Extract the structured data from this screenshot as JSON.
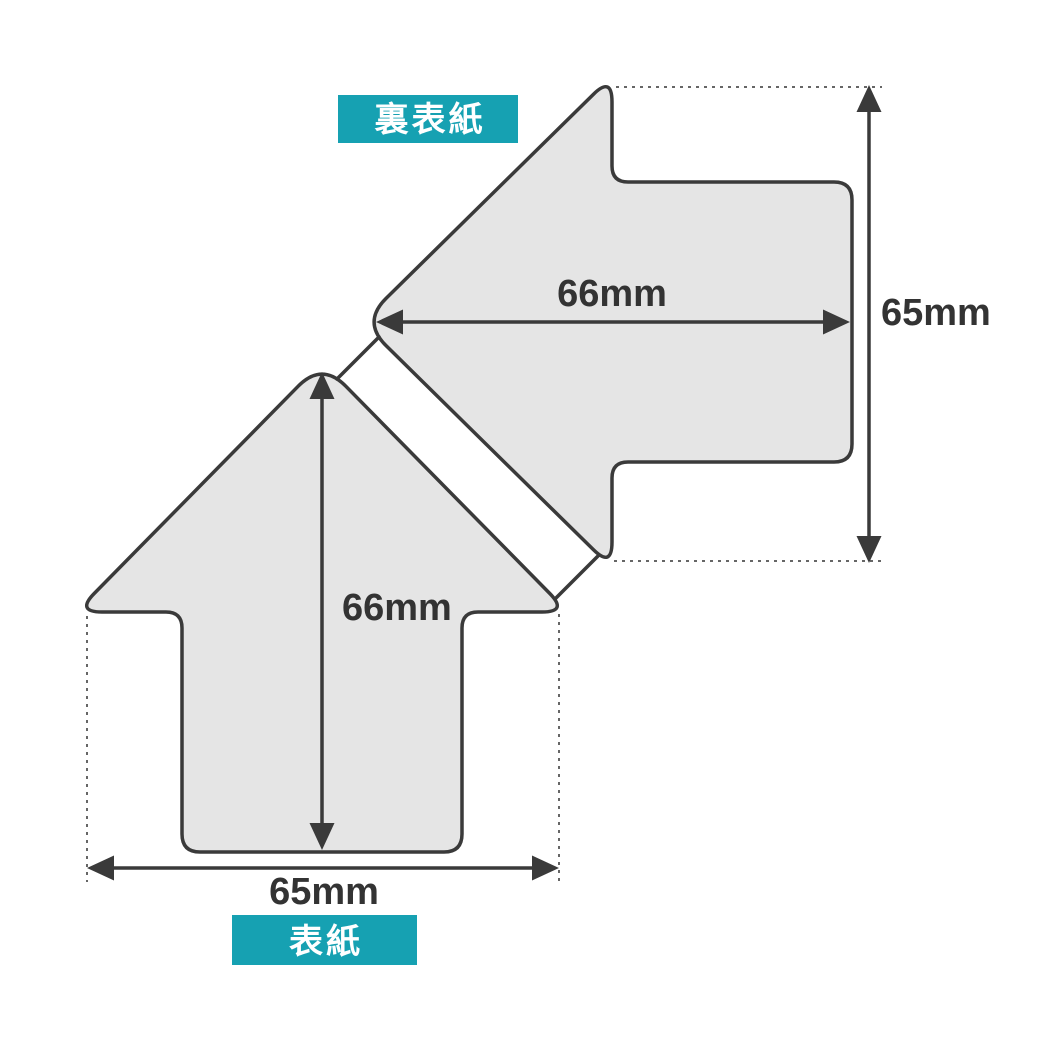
{
  "diagram": {
    "title_context": "arrow-shaped cover die-cut dimensions",
    "back_cover": {
      "label": "裏表紙",
      "width_label": "66mm",
      "height_label": "65mm"
    },
    "front_cover": {
      "label": "表紙",
      "height_label": "66mm",
      "width_label": "65mm"
    },
    "colors": {
      "accent_teal": "#16A1B2",
      "shape_fill": "#E5E5E5",
      "outline": "#3A3A3A",
      "dimension_text": "#333333"
    }
  }
}
